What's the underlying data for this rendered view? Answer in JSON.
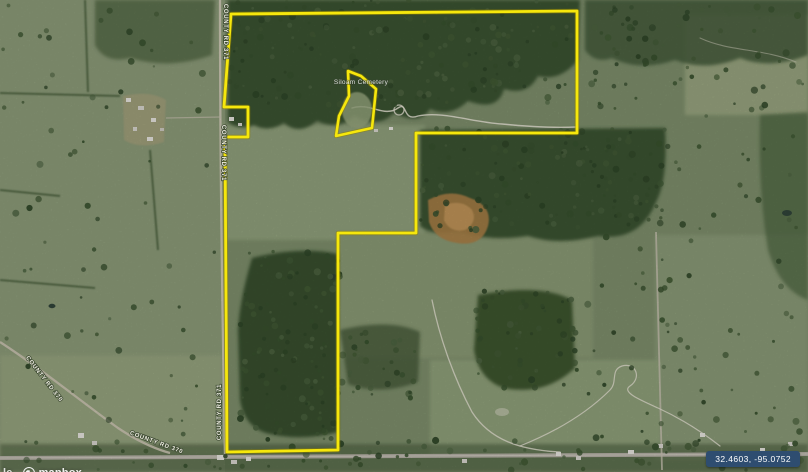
{
  "map": {
    "coordinates_badge": {
      "text": "32.4603, -95.0752",
      "bg": "#2e4d70"
    },
    "attribution": {
      "fragment": "le",
      "logo_text": "mapbox"
    },
    "poi": {
      "cemetery_label": "Siloam Cemetery",
      "x": 361,
      "y": 84
    },
    "road_labels": [
      {
        "text": "COUNTY RD 371",
        "x": 224,
        "y": 32,
        "rotate": 90
      },
      {
        "text": "COUNTY RD 371",
        "x": 222,
        "y": 153,
        "rotate": 90
      },
      {
        "text": "COUNTY RD 371",
        "x": 221,
        "y": 412,
        "rotate": -90
      },
      {
        "text": "COUNTY RD 370",
        "x": 43,
        "y": 380,
        "rotate": 52
      },
      {
        "text": "COUNTY RD 370",
        "x": 156,
        "y": 444,
        "rotate": 20
      }
    ],
    "boundary": {
      "color": "#f6e70c",
      "halo_color": "#8c7e00",
      "main_points": [
        [
          231,
          14
        ],
        [
          577,
          11
        ],
        [
          577,
          133
        ],
        [
          416,
          133
        ],
        [
          416,
          233
        ],
        [
          338,
          233
        ],
        [
          338,
          450
        ],
        [
          227,
          452
        ],
        [
          225,
          137
        ],
        [
          248,
          137
        ],
        [
          248,
          107
        ],
        [
          224,
          107
        ]
      ],
      "cemetery_points": [
        [
          348,
          71
        ],
        [
          361,
          76
        ],
        [
          376,
          89
        ],
        [
          372,
          128
        ],
        [
          336,
          136
        ],
        [
          339,
          116
        ],
        [
          349,
          96
        ]
      ]
    }
  }
}
